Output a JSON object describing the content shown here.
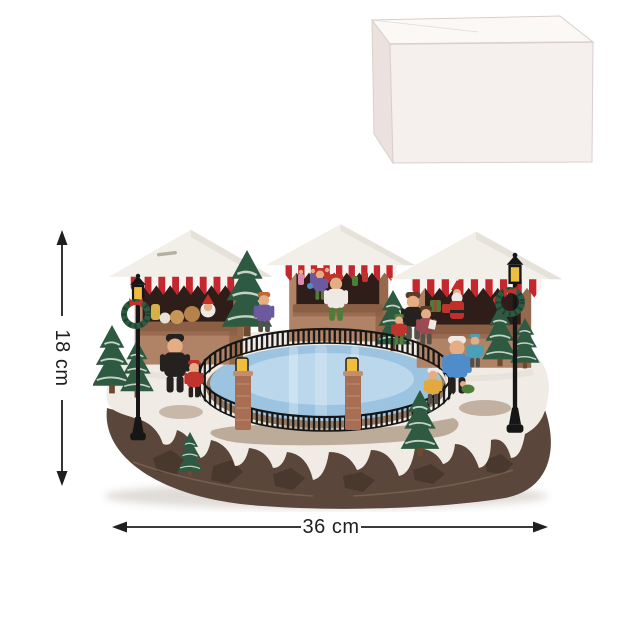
{
  "annotations": {
    "height_label": "18 cm",
    "width_label": "36 cm"
  },
  "scene": {
    "name": "christmas-market-ice-skating-rink-figurine",
    "parts": [
      "market-stall-left",
      "market-stall-center",
      "market-stall-right",
      "ice-rink",
      "rink-fence",
      "brick-lantern-posts",
      "street-lamp-left",
      "street-lamp-right",
      "wreaths",
      "christmas-trees",
      "skater-figures",
      "snow-ground",
      "rock-base"
    ],
    "colors": {
      "bg": "#ffffff",
      "ink": "#1f1f1f",
      "box_top": "#fbf8f6",
      "box_front": "#f5efed",
      "box_side": "#ebe2e0",
      "box_edge": "#d9cfcc",
      "wood": "#b08266",
      "wood_dark": "#8a5e44",
      "wood_side": "#96684c",
      "interior": "#2e1d18",
      "counter": "#8a5f43",
      "awn_red": "#c5272e",
      "awn_white": "#f6f4f0",
      "roof": "#f2efe9",
      "roof_shadow": "#d9d3c9",
      "tree": "#2e5a41",
      "tree_dark": "#1d4130",
      "tree_snow": "#dfe7df",
      "trunk": "#6b4a32",
      "ice": "#9cc4e0",
      "ice_light": "#cfe5f2",
      "shore": "#8a6b50",
      "fence": "#161616",
      "brick": "#a86e54",
      "brick_light": "#c28e6e",
      "glow": "#f0be3e",
      "snow": "#f0ebe4",
      "snow_shadow": "#d8d0c5",
      "rock": "#5a463a",
      "rock_dark": "#3c2d24",
      "rock_light": "#8a7263",
      "skin": "#e5ad83",
      "shadow": "#b9b1a6",
      "fig_red": "#bf342c",
      "fig_blue": "#4f8cca",
      "fig_purple": "#6d5a9e",
      "fig_yellow": "#e2a93e",
      "fig_green": "#4e7d3a",
      "fig_black": "#24211f",
      "fig_teal": "#4aa0b8",
      "fig_white": "#efe9e6",
      "fig_pink": "#d88ab0",
      "fig_maroon": "#9c4a52",
      "santa_red": "#c22f28",
      "hair_orange": "#c06a32",
      "hair_brown": "#5a3c28",
      "grey_pants": "#55504a"
    }
  },
  "packaging": {
    "name": "plain-white-carton-box"
  }
}
